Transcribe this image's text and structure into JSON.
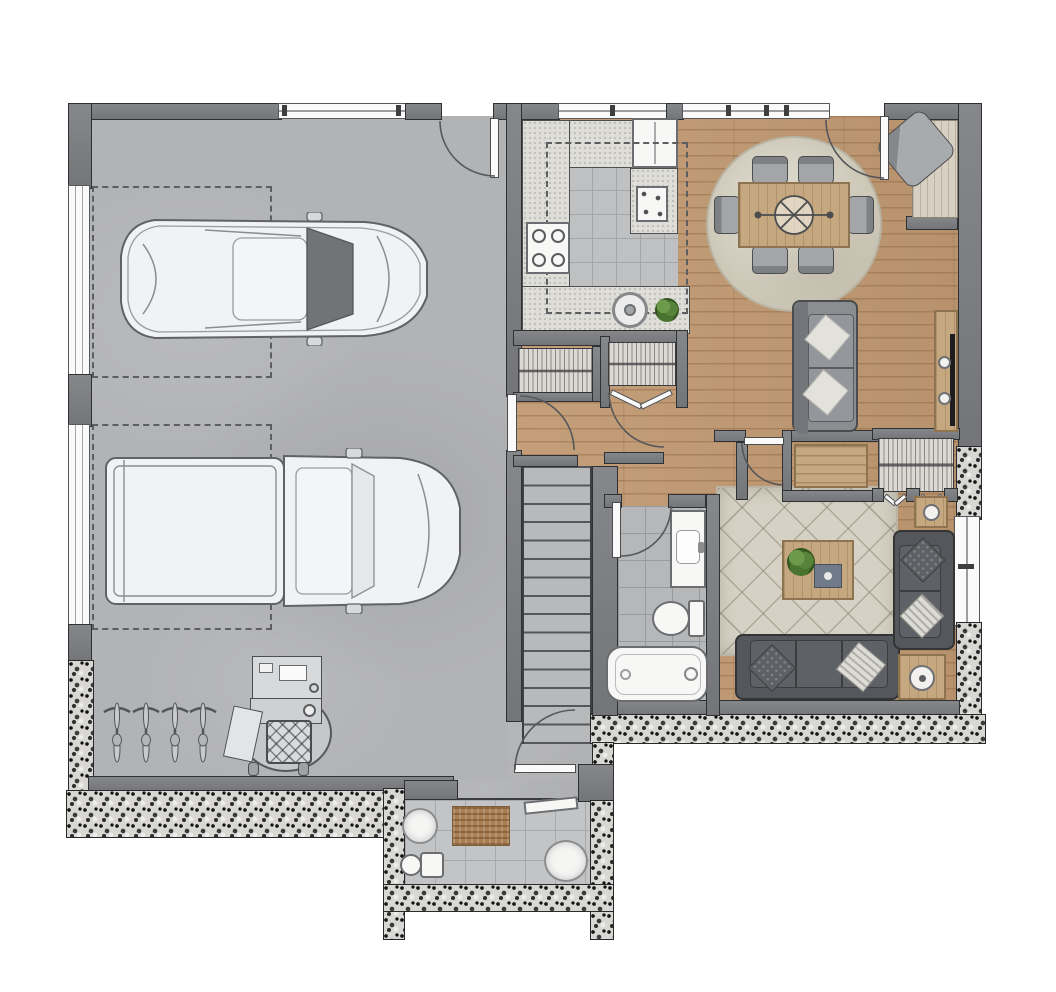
{
  "meta": {
    "title": "Residential floor plan - garage level",
    "view": "top-down 2D rendered architectural plan",
    "canvas": {
      "width": 1056,
      "height": 992
    }
  },
  "colors": {
    "bg": "#ffffff",
    "wall_fill": "#7d7f82",
    "wall_edge": "#2e3032",
    "window_fill": "#fafafa",
    "window_frame": "#56585b",
    "glass_line": "#9b9da0",
    "concrete": "#b2b3b5",
    "wood_floor": "#c19a72",
    "tile": "#bfc0c2",
    "tile_grout": "#a5a6a8",
    "bath_tile": "#b6b7b9",
    "counter": "#deddd7",
    "counter_edge": "#4c4e50",
    "stone_base": "#d8d7d3",
    "stone_dark": "#1c1c1c",
    "rug_base": "#d5d1c4",
    "rug_line": "#8f8a79",
    "round_rug": "#d0ccbf",
    "sofa_gray": "#8b8e91",
    "sofa_charcoal": "#54575b",
    "sofa_edge": "#323436",
    "pillow_light": "#e3e1dc",
    "pillow_dark": "#5d6064",
    "furn_wood": "#c5a87f",
    "furn_wood_dark": "#8d734f",
    "fixture_white": "#f7f7f6",
    "fixture_edge": "#6b6d70",
    "plant": "#527c38",
    "doormat": "#a87e52",
    "tv": "#1d1d1f",
    "dash": "#5c5e60",
    "arc": "#55575a",
    "vehicle_body": "#f1f2f3",
    "vehicle_edge": "#606266",
    "windshield": "#717477",
    "chair_gray": "#9da0a3",
    "stair_bg": "#b8b9bb",
    "stair_line": "#55575a",
    "hatch_bg": "#dcd9d3"
  },
  "rooms": [
    {
      "id": "garage",
      "label": "two-car garage",
      "features": [
        "concrete floor",
        "sedan",
        "pickup truck",
        "4 bicycles",
        "work station",
        "2 garage doors on left wall",
        "window on top wall",
        "side door with swing",
        "dashed parking outlines"
      ]
    },
    {
      "id": "kitchen",
      "label": "kitchen",
      "features": [
        "L-shaped speckled counter",
        "4-burner cooktop",
        "refrigerator",
        "wall oven",
        "round sink on peninsula",
        "potted plant",
        "dashed upper-cabinet outline",
        "tile floor"
      ]
    },
    {
      "id": "dining",
      "label": "dining room",
      "features": [
        "wood floor",
        "round area rug",
        "table for six",
        "6 chairs",
        "ceiling fixture symbol",
        "corner armchair nook",
        "rear entry door with swing",
        "windows on top wall"
      ]
    },
    {
      "id": "living",
      "label": "living room",
      "features": [
        "diamond-pattern rug",
        "3-seat charcoal sofa",
        "loveseat on right wall",
        "gray sofa facing TV",
        "coffee table with plant and tray",
        "2 side tables with lamps",
        "TV console with TV",
        "window on right wall"
      ]
    },
    {
      "id": "hallway",
      "label": "hallway",
      "features": [
        "coat closet",
        "pantry closet with bifold doors",
        "storage niche with dresser",
        "wardrobe closet with double bifold doors",
        "door to garage",
        "door to living room"
      ]
    },
    {
      "id": "stairs",
      "label": "staircase",
      "features": [
        "straight run",
        "about 15 treads"
      ]
    },
    {
      "id": "bathroom",
      "label": "bathroom",
      "features": [
        "tile floor",
        "vanity with sink",
        "toilet",
        "bathtub",
        "door with swing"
      ]
    },
    {
      "id": "porch",
      "label": "entry porch",
      "features": [
        "stone exterior walls",
        "tile floor",
        "doormat",
        "2 round planters",
        "small seat",
        "bench"
      ]
    }
  ]
}
